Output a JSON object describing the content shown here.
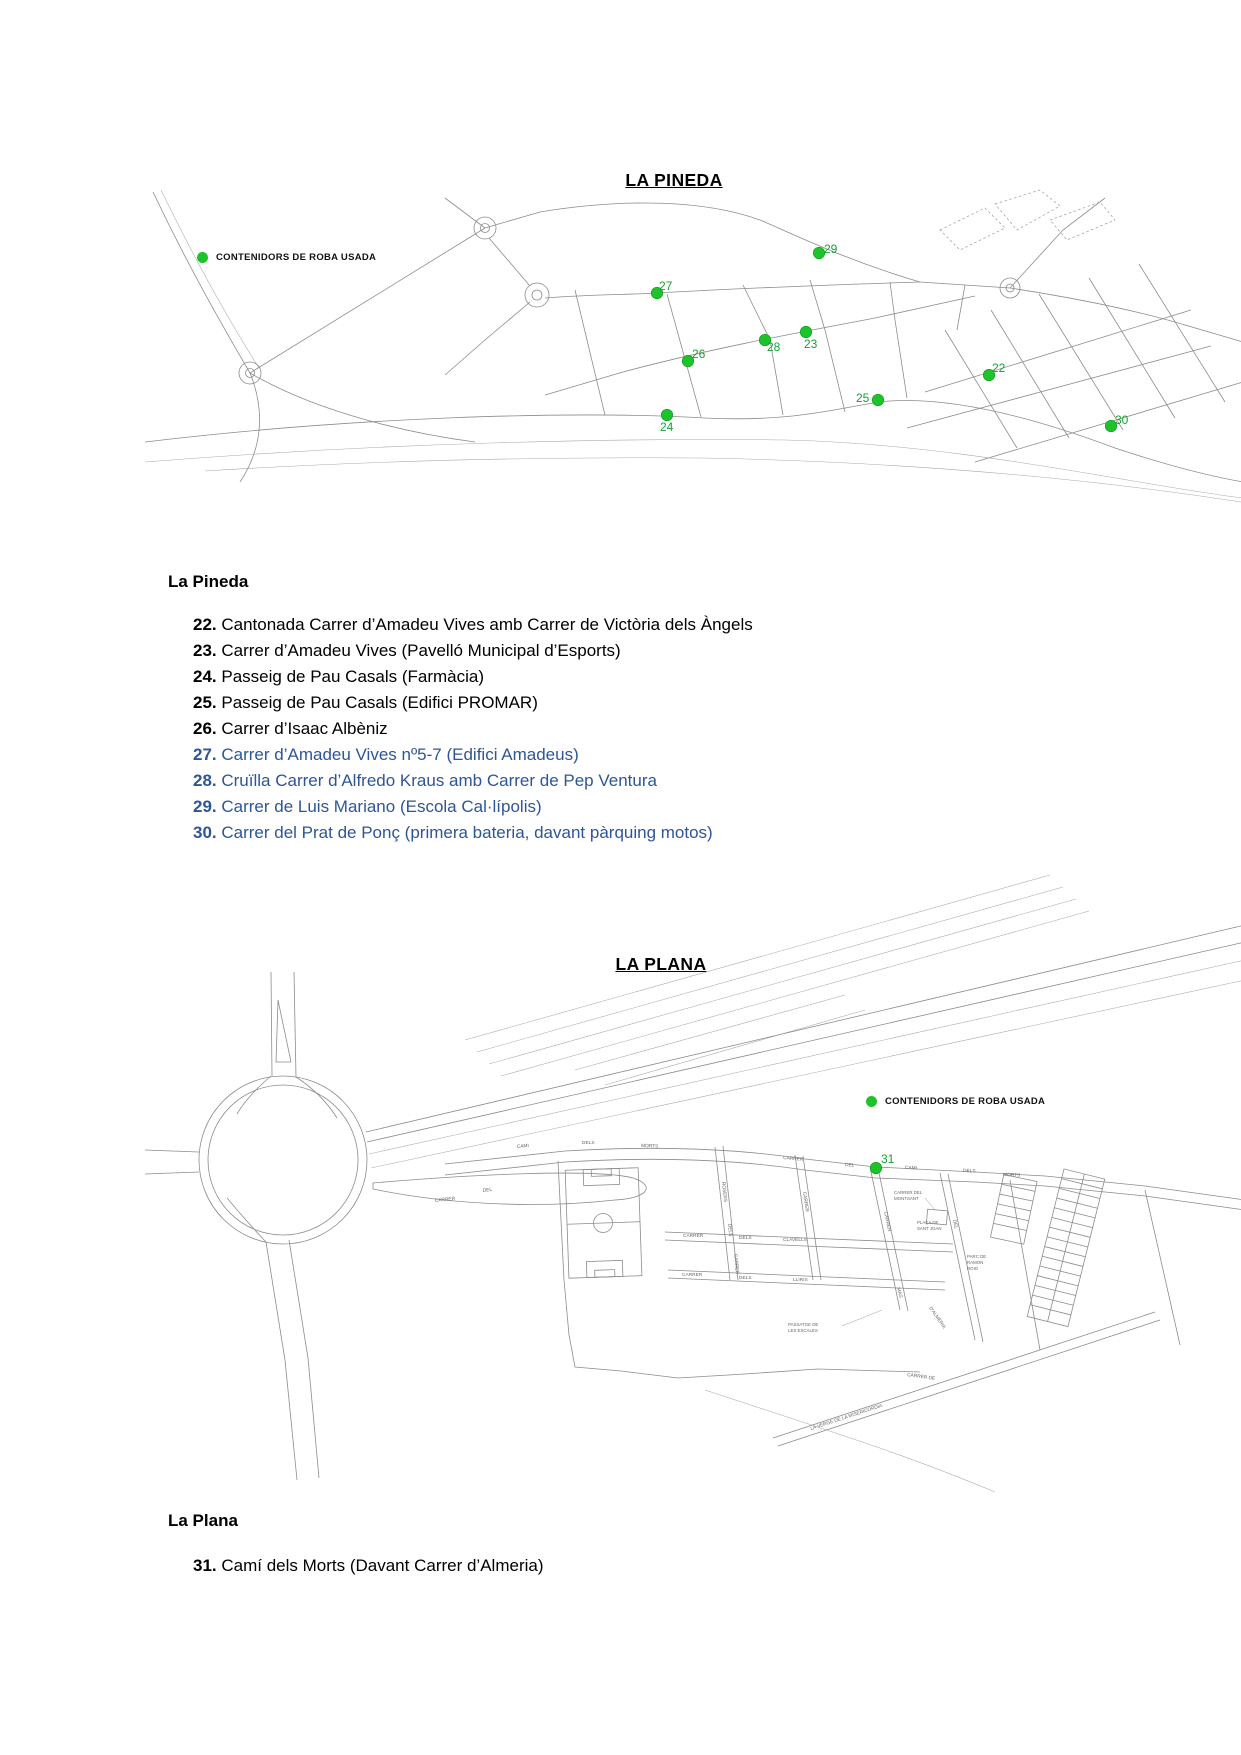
{
  "colors": {
    "green": "#1dc32b",
    "label-green": "#17a033",
    "blue": "#2e5596",
    "map-line": "#8c8c8c"
  },
  "map1": {
    "title": "LA PINEDA",
    "legend_label": "CONTENIDORS DE ROBA USADA",
    "points": [
      {
        "n": "29",
        "x": 819,
        "y": 253,
        "lx": 824,
        "ly": 243
      },
      {
        "n": "27",
        "x": 657,
        "y": 293,
        "lx": 659,
        "ly": 280
      },
      {
        "n": "23",
        "x": 806,
        "y": 332,
        "lx": 804,
        "ly": 338
      },
      {
        "n": "28",
        "x": 765,
        "y": 340,
        "lx": 767,
        "ly": 341
      },
      {
        "n": "26",
        "x": 688,
        "y": 361,
        "lx": 692,
        "ly": 348
      },
      {
        "n": "22",
        "x": 989,
        "y": 375,
        "lx": 992,
        "ly": 362
      },
      {
        "n": "25",
        "x": 878,
        "y": 400,
        "lx": 856,
        "ly": 392
      },
      {
        "n": "24",
        "x": 667,
        "y": 415,
        "lx": 660,
        "ly": 421
      },
      {
        "n": "30",
        "x": 1111,
        "y": 426,
        "lx": 1115,
        "ly": 414
      }
    ]
  },
  "section1": {
    "heading": "La Pineda",
    "items": [
      {
        "n": "22.",
        "text": "Cantonada Carrer d’Amadeu Vives amb Carrer de Victòria dels Àngels",
        "color": "black"
      },
      {
        "n": "23.",
        "text": "Carrer d’Amadeu Vives (Pavelló Municipal d’Esports)",
        "color": "black"
      },
      {
        "n": "24.",
        "text": "Passeig de Pau Casals (Farmàcia)",
        "color": "black"
      },
      {
        "n": "25.",
        "text": "Passeig de Pau Casals (Edifici PROMAR)",
        "color": "black"
      },
      {
        "n": "26.",
        "text": "Carrer d’Isaac Albèniz",
        "color": "black"
      },
      {
        "n": "27.",
        "text": "Carrer d’Amadeu Vives nº5-7 (Edifici Amadeus)",
        "color": "blue"
      },
      {
        "n": "28.",
        "text": "Cruïlla Carrer d’Alfredo Kraus amb Carrer de Pep Ventura",
        "color": "blue"
      },
      {
        "n": "29.",
        "text": "Carrer de Luis Mariano (Escola Cal·lípolis)",
        "color": "blue"
      },
      {
        "n": "30.",
        "text": "Carrer del Prat de Ponç (primera bateria, davant pàrquing motos)",
        "color": "blue"
      }
    ]
  },
  "map2": {
    "title": "LA PLANA",
    "legend_label": "CONTENIDORS DE ROBA USADA",
    "points": [
      {
        "n": "31",
        "x": 876,
        "y": 1168,
        "lx": 881,
        "ly": 1153
      }
    ],
    "streets": {
      "cami": "CAMI",
      "dels": "DELS",
      "morts": "MORTS",
      "carrer": "CARRER",
      "del": "DEL",
      "rosers": "ROSERS",
      "clavells": "CLAVELLS",
      "lliris": "LLIRIS",
      "mas": "MAS",
      "montsant_1": "CARRER DEL",
      "montsant_2": "MONTSANT",
      "placa_1": "PLAÇA DE",
      "placa_2": "SANT JOAN",
      "parc_1": "PARC DE",
      "parc_2": "RAMON",
      "parc_3": "ROIG",
      "passatge_1": "PASSATGE DE",
      "passatge_2": "LES ESCALES",
      "almeria": "D'ALMERIA",
      "carrer_de": "CARRER DE",
      "verge": "LA VERGE DE LA MISERICORDIA"
    }
  },
  "section2": {
    "heading": "La Plana",
    "items": [
      {
        "n": "31.",
        "text": "Camí dels Morts (Davant Carrer d’Almeria)",
        "color": "black"
      }
    ]
  }
}
